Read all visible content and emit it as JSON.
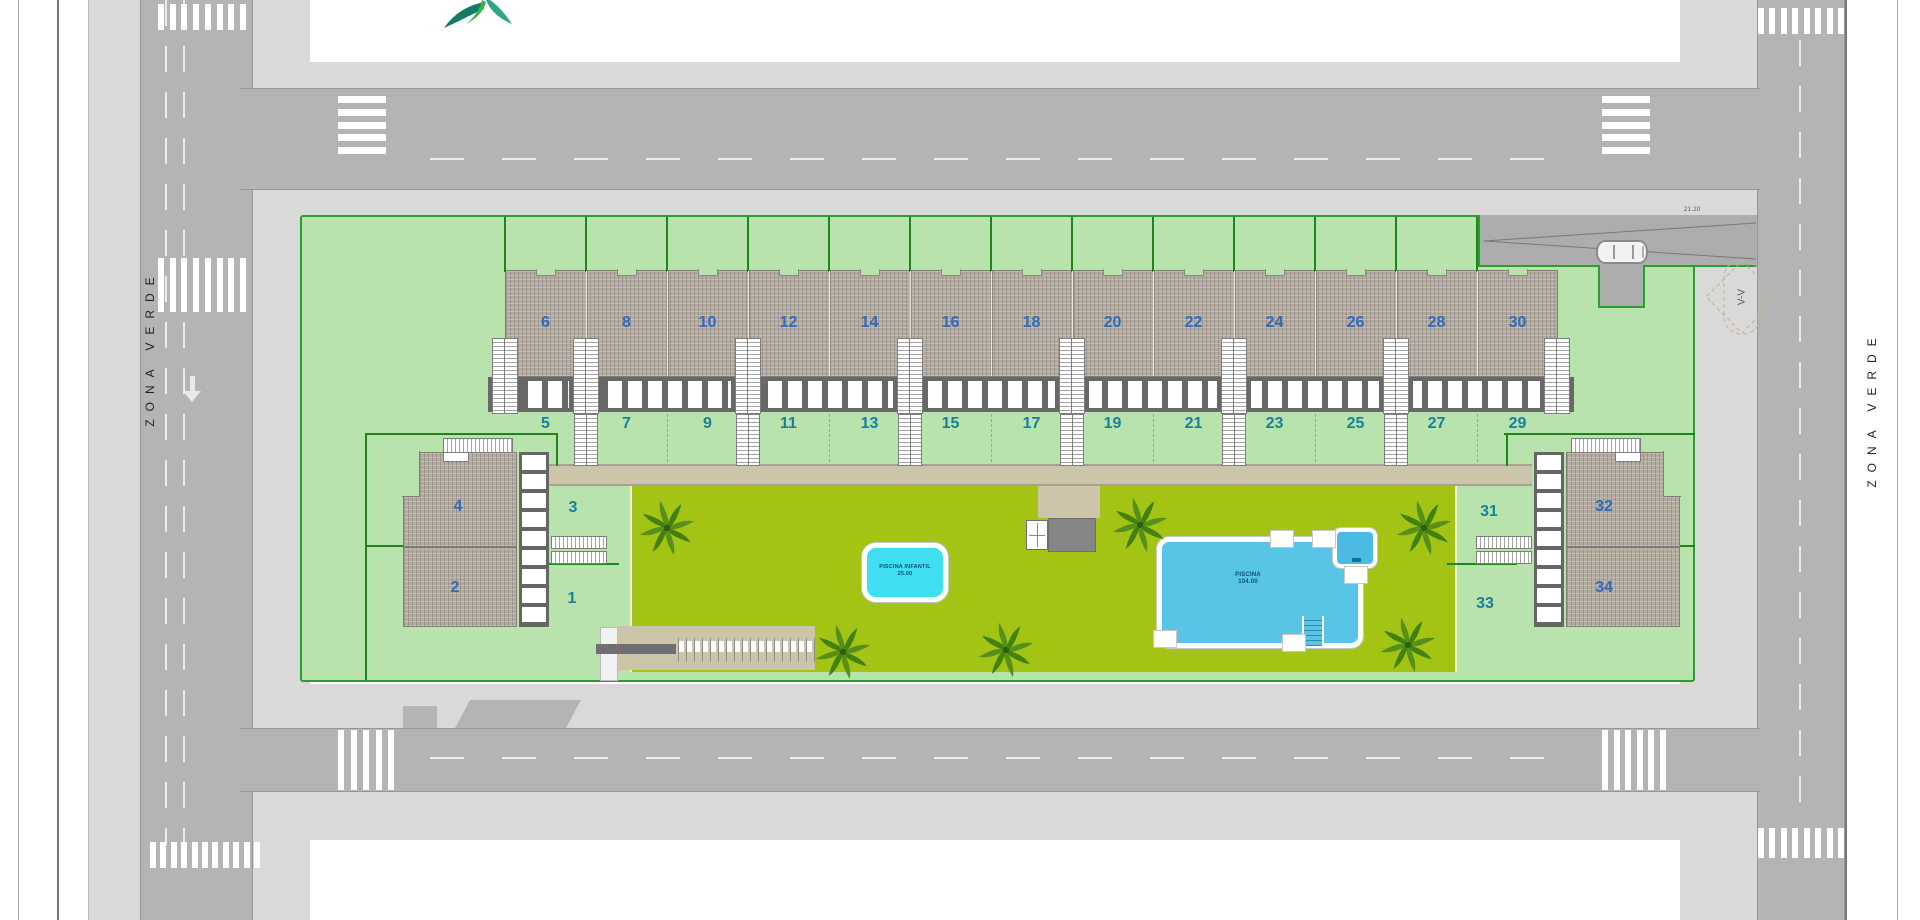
{
  "labels": {
    "zona_verde_left": "ZONA VERDE",
    "zona_verde_right": "ZONA VERDE",
    "driveway_dim": "21.20",
    "section_marker": "V-V"
  },
  "units": {
    "upper_row": [
      "6",
      "8",
      "10",
      "12",
      "14",
      "16",
      "18",
      "20",
      "22",
      "24",
      "26",
      "28",
      "30"
    ],
    "upper_gardens": [
      "5",
      "7",
      "9",
      "11",
      "13",
      "15",
      "17",
      "19",
      "21",
      "23",
      "25",
      "27",
      "29"
    ],
    "left_cluster": {
      "top_unit": "4",
      "bottom_unit": "2",
      "top_garden": "3",
      "bottom_garden": "1"
    },
    "right_cluster": {
      "top_unit": "32",
      "bottom_unit": "34",
      "top_garden": "31",
      "bottom_garden": "33"
    }
  },
  "pools": {
    "kids_pool": {
      "line1": "PISCINA INFANTIL",
      "line2": "25.00"
    },
    "main_pool": {
      "line1": "PISCINA",
      "line2": "104.00"
    }
  },
  "colors": {
    "site_green": "#b9e3ad",
    "site_border": "#2aa02a",
    "amenity_green": "#a3c315",
    "walkway_tan": "#cdc5aa",
    "road_gray": "#b4b4b4",
    "sidewalk_gray": "#d9d9d9",
    "roof_hatch": "#b3aaa0",
    "kids_pool_cyan": "#3fdef0",
    "main_pool_blue": "#58c4e6",
    "unit_number_blue": "#2f6bbf",
    "garden_number_teal": "#187f9e"
  }
}
